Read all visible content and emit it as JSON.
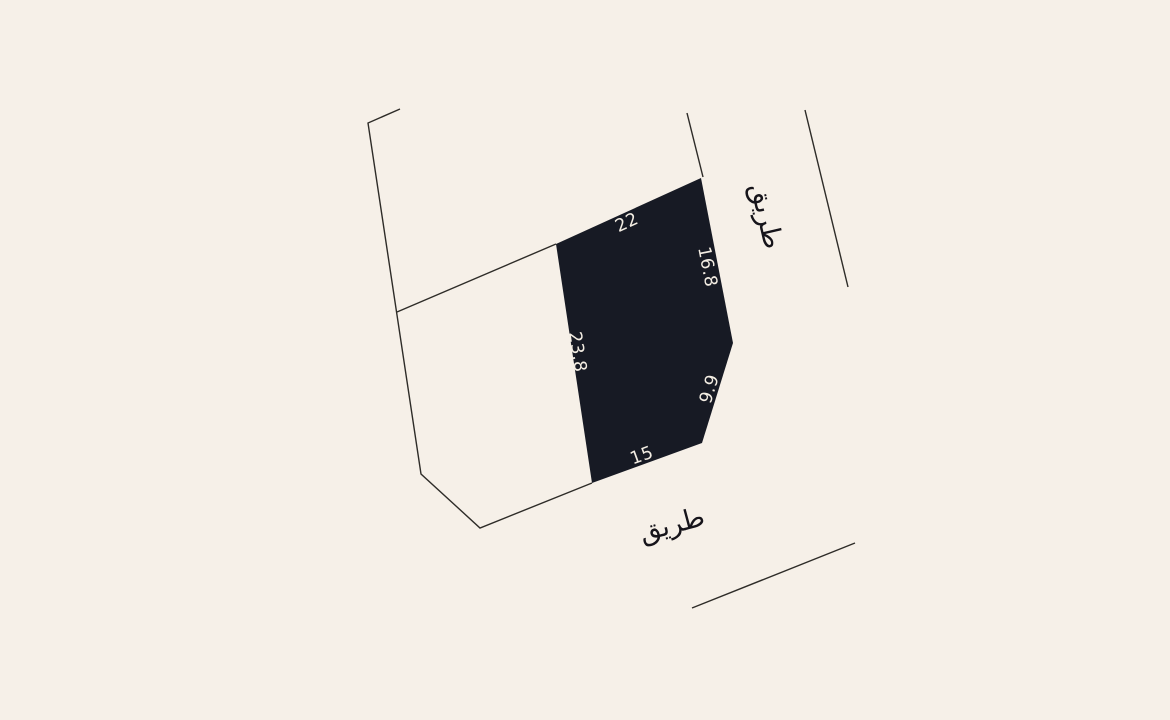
{
  "canvas": {
    "width": 1170,
    "height": 720
  },
  "colors": {
    "background": "#f6f0e8",
    "plot_fill": "#171a24",
    "boundary_line": "#2e2c28",
    "dimension_text": "#f3ede3",
    "road_text": "#16141a"
  },
  "plot": {
    "points": "556,244 701,178 733,343 702,443 592,483",
    "dimensions": [
      {
        "label": "22",
        "transform": "translate(627,223) rotate(-24.5)"
      },
      {
        "label": "16.8",
        "transform": "translate(707,267) rotate(79)"
      },
      {
        "label": "9.9",
        "transform": "translate(710,389) rotate(-73)"
      },
      {
        "label": "15",
        "transform": "translate(642,456) rotate(-20)"
      },
      {
        "label": "23.8",
        "transform": "translate(577,352) rotate(81.5)"
      }
    ]
  },
  "boundaries": [
    {
      "name": "left-parcel-outline",
      "points": "400,109 368,123 421,474 480,528 592,483"
    },
    {
      "name": "parcel-divider",
      "points": "397,312 556,244"
    },
    {
      "name": "top-right-boundary",
      "points": "687,113 703,177"
    },
    {
      "name": "right-road-edge",
      "points": "805,110 848,287"
    },
    {
      "name": "bottom-road-edge",
      "points": "692,608 855,543"
    }
  ],
  "road_labels": [
    {
      "text": "طريق",
      "transform": "translate(766,216) rotate(77)"
    },
    {
      "text": "طريق",
      "transform": "translate(672,525) rotate(-15)"
    }
  ]
}
